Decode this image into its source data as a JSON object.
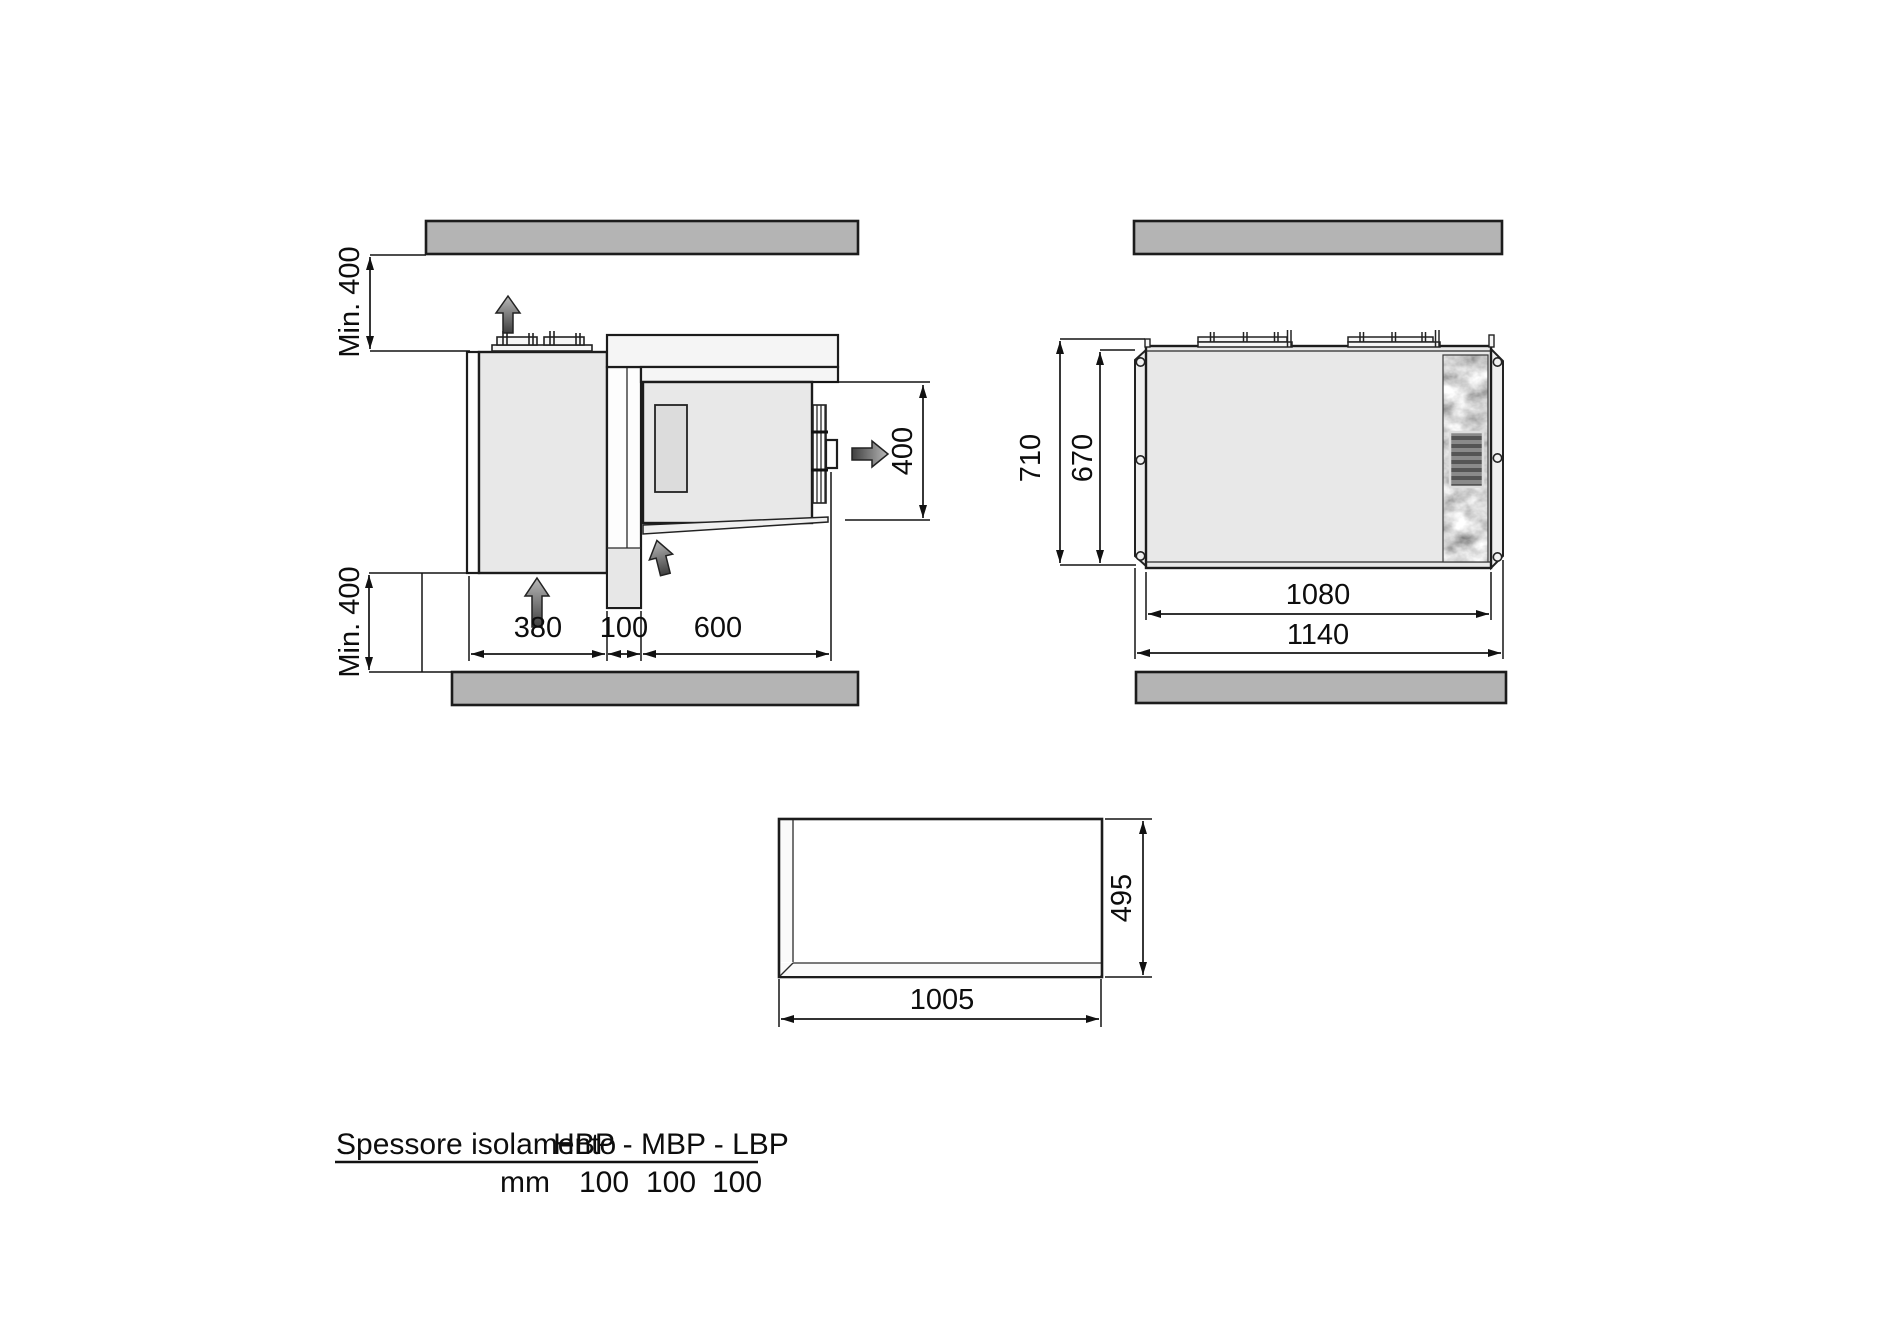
{
  "colors": {
    "background": "#ffffff",
    "obstacle_bar": "#b4b4b4",
    "unit_fill": "#e8e8e8",
    "panel_fill": "#f5f5f5",
    "line": "#1c1c1c"
  },
  "left_view": {
    "min_clearance_top": "Min. 400",
    "min_clearance_bottom": "Min. 400",
    "external_depth": "380",
    "wall_thickness": "100",
    "internal_depth": "600",
    "unit_height": "400"
  },
  "right_view": {
    "overall_height": "710",
    "body_height": "670",
    "body_width": "1080",
    "overall_width": "1140"
  },
  "opening_view": {
    "width": "1005",
    "height": "495"
  },
  "table": {
    "row_header": "Spessore isolamento",
    "col_header": "HBP - MBP - LBP",
    "unit_label": "mm",
    "values": [
      "100",
      "100",
      "100"
    ]
  }
}
